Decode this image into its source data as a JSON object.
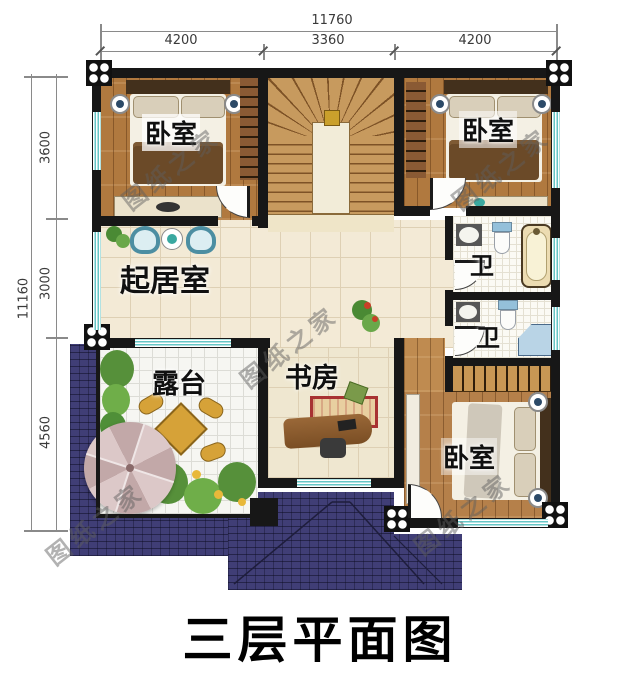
{
  "title": "三层平面图",
  "watermark_text": "图纸之家",
  "dimensions": {
    "top": {
      "total": "11760",
      "segments": [
        "4200",
        "3360",
        "4200"
      ]
    },
    "left": {
      "total": "11160",
      "segments": [
        "3600",
        "3000",
        "4560"
      ]
    }
  },
  "rooms": {
    "bedroom_top_left": "卧室",
    "bedroom_top_right": "卧室",
    "bedroom_bottom_right": "卧室",
    "living_room": "起居室",
    "bathroom_upper": "卫",
    "bathroom_lower": "卫",
    "terrace": "露台",
    "study": "书房"
  },
  "colors": {
    "wall": "#171717",
    "roof": "#403e76",
    "window_teal": "#66c6c6",
    "wood": "#b0793f"
  }
}
